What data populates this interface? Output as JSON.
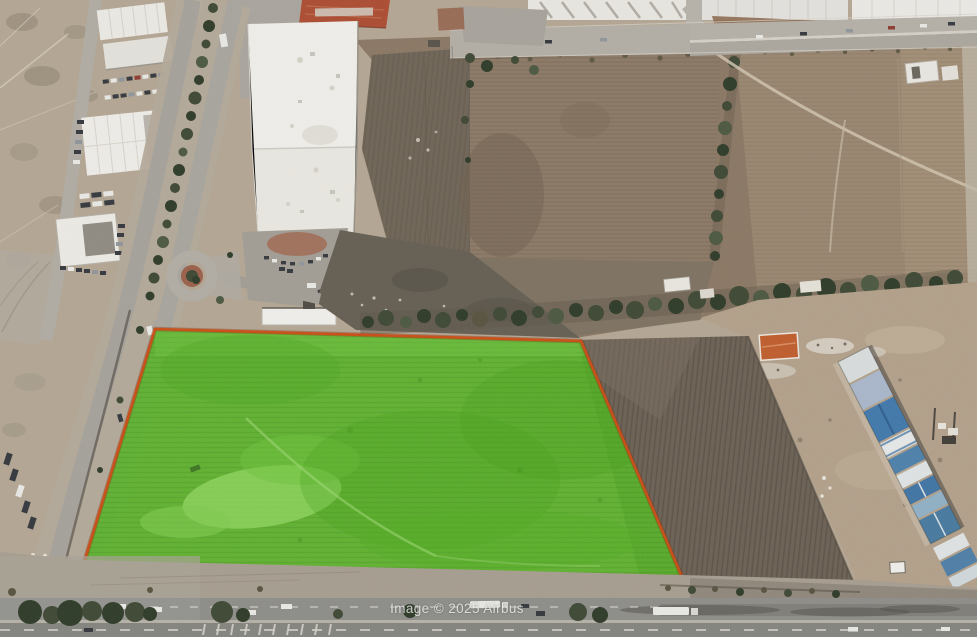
{
  "map": {
    "attribution": "Image © 2025 Airbus",
    "colors": {
      "terrain_base": "#b3a693",
      "parcel_fill": "#57b426",
      "parcel_border": "#cf4a12"
    }
  }
}
